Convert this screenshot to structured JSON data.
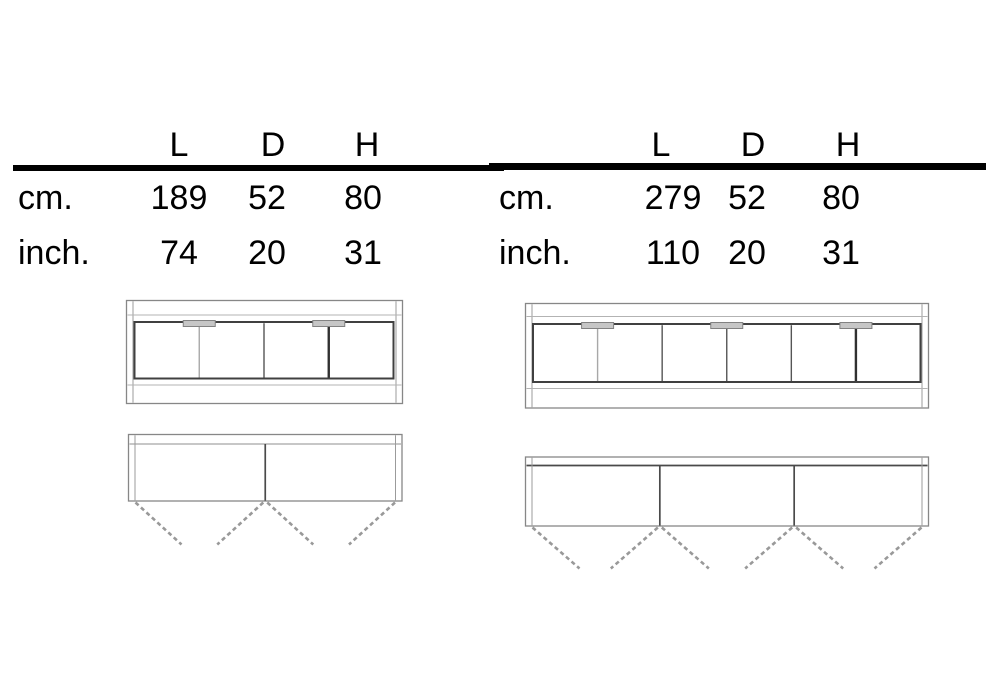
{
  "page": {
    "background": "#ffffff"
  },
  "tables": [
    {
      "name": "dimensions-table-left",
      "columns": [
        "L",
        "D",
        "H"
      ],
      "rows": [
        {
          "label": "cm.",
          "values": [
            "189",
            "52",
            "80"
          ]
        },
        {
          "label": "inch.",
          "values": [
            "74",
            "20",
            "31"
          ]
        }
      ]
    },
    {
      "name": "dimensions-table-right",
      "columns": [
        "L",
        "D",
        "H"
      ],
      "rows": [
        {
          "label": "cm.",
          "values": [
            "279",
            "52",
            "80"
          ]
        },
        {
          "label": "inch.",
          "values": [
            "110",
            "20",
            "31"
          ]
        }
      ]
    }
  ],
  "diagrams": [
    {
      "name": "sideboard-189-front-and-plan",
      "views": [
        "front-elevation",
        "plan-view"
      ],
      "doors": 4,
      "handle_positions": [
        1,
        3
      ],
      "plan_dividers": 1,
      "door_swings": 4
    },
    {
      "name": "sideboard-279-front-and-plan",
      "views": [
        "front-elevation",
        "plan-view"
      ],
      "doors": 6,
      "handle_positions": [
        1,
        3,
        5
      ],
      "plan_dividers": 2,
      "door_swings": 6
    }
  ],
  "colors": {
    "rule": "#000000",
    "text": "#000000",
    "frame_line": "#878787",
    "side_line": "#9b9b9b",
    "light_line": "#b3b3b3",
    "door_frame": "#404040",
    "divider": "#555555",
    "divider_dark": "#303030",
    "divider_light": "#a8a8a8",
    "handle_fill": "#c6c6c6",
    "handle_stroke": "#828282",
    "swing_dash": "#999999"
  }
}
